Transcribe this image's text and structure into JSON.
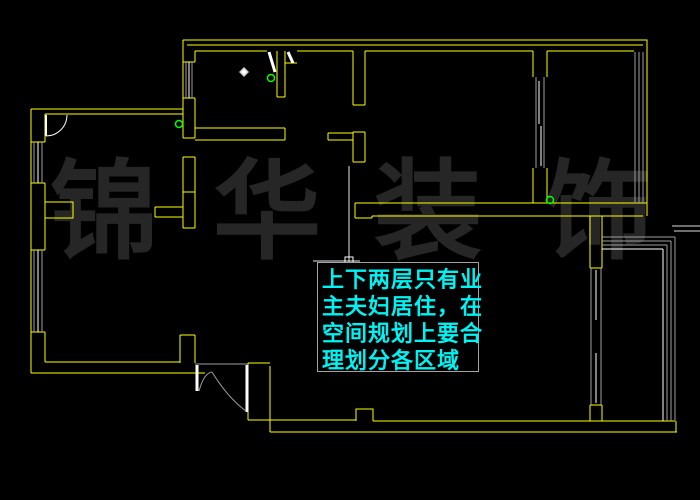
{
  "canvas": {
    "background_color": "#000000",
    "type_label": "CAD floor plan drawing"
  },
  "watermark": {
    "text": "锦华装饰",
    "chars": [
      "锦",
      "华",
      "装",
      "饰"
    ],
    "color": "#262626"
  },
  "annotation": {
    "lines": [
      "上下两层只有业",
      "主夫妇居住，在",
      "空间规划上要合",
      "理划分各区域"
    ],
    "text_color": "#00f2f2",
    "border_color": "#a3a3a3"
  },
  "colors": {
    "wall": "#ffff00",
    "window": "#9e9e9e",
    "door_leaf": "#ffffff",
    "door_swing": "#9e9e9e",
    "node_marker": "#00ff00",
    "leader": "#f0f0f0",
    "lamp_dot": "#cccccc"
  },
  "markers": {
    "node_count": "3",
    "lamp_count": "1"
  }
}
